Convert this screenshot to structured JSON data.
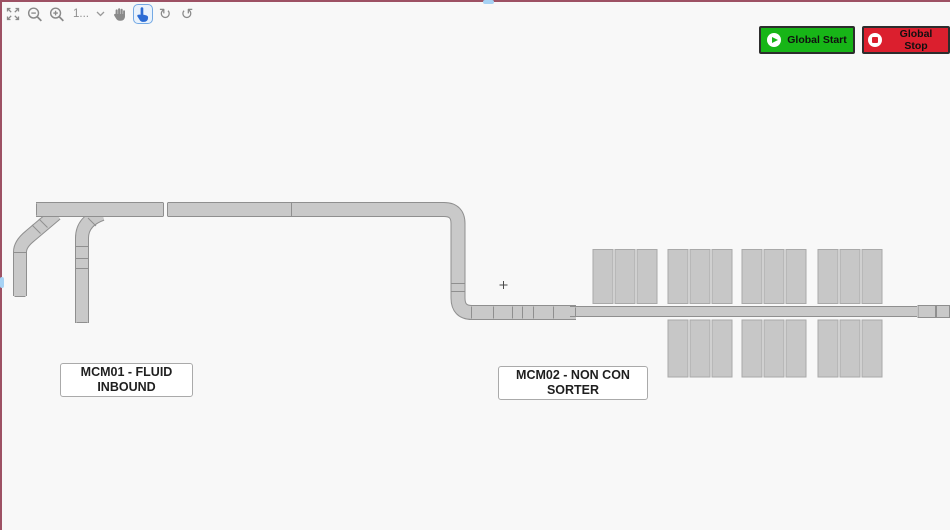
{
  "colors": {
    "window_border": "#9d5164",
    "canvas_bg": "#f8f8f8",
    "belt_fill": "#c9c9c9",
    "belt_stroke": "#8f8f8f",
    "chute_fill": "#c7c7c7",
    "chute_stroke": "#a9a9a9",
    "start_green": "#17b517",
    "stop_red": "#db1f2e",
    "button_border": "#2d2d2d",
    "toolbar_icon": "#8a8a8a",
    "active_tool": "#2b6bd4",
    "active_tool_border": "#74a9e4",
    "active_tool_bg": "#e9f2fc",
    "scroll_thumb": "#a6d2f4",
    "label_border": "#aaaaaa"
  },
  "toolbar": {
    "zoom_level_value": "1...",
    "rotate_glyph": "↻",
    "reset_glyph": "↺"
  },
  "actions": {
    "start_label": "Global Start",
    "stop_label": "Global Stop"
  },
  "labels": {
    "mcm01": {
      "line1": "MCM01 - FLUID",
      "line2": "INBOUND"
    },
    "mcm02": {
      "line1": "MCM02 - NON CON",
      "line2": "SORTER"
    }
  },
  "diagram": {
    "belts": [
      {
        "name": "mcm01-branch-left-belt",
        "path": "M 56 214 L 30 236 Q 20 244 20 252 L 20 296",
        "width": 12
      },
      {
        "name": "mcm01-branch-mid-belt",
        "path": "M 102 214 Q 82 221 82 238 L 82 323",
        "width": 12
      },
      {
        "name": "mcm01-main-belt",
        "path": "M 36 209.5 L 444 209.5 Q 458 209.5 458 223.5 L 458 298 Q 458 312.5 472 312.5 L 576 312.5",
        "width": 13
      },
      {
        "name": "mcm02-sorter-belt",
        "path": "M 570 311.5 L 917 311.5",
        "width": 9
      }
    ],
    "belt_gap": {
      "x": 163.5,
      "y": 201.5,
      "w": 4,
      "h": 16
    },
    "separators": [
      [
        36.5,
        203.5,
        36.5,
        215.5
      ],
      [
        163.5,
        203,
        163.5,
        216
      ],
      [
        167.5,
        203,
        167.5,
        216
      ],
      [
        291.5,
        203,
        291.5,
        216
      ],
      [
        451.5,
        283.5,
        464.5,
        283.5
      ],
      [
        451.5,
        291.5,
        464.5,
        291.5
      ],
      [
        471.5,
        306.5,
        471.5,
        318.5
      ],
      [
        493.5,
        306.5,
        493.5,
        318.5
      ],
      [
        512.5,
        306.5,
        512.5,
        318.5
      ],
      [
        522.5,
        306.5,
        522.5,
        318.5
      ],
      [
        533.5,
        306.5,
        533.5,
        318.5
      ],
      [
        553.5,
        306.5,
        553.5,
        318.5
      ],
      [
        575.5,
        307.5,
        575.5,
        316
      ],
      [
        39,
        219,
        47.5,
        227.5
      ],
      [
        32,
        225,
        40.5,
        233.5
      ],
      [
        88,
        218,
        96,
        226
      ],
      [
        76,
        246.5,
        88,
        246.5
      ],
      [
        76,
        258.5,
        88,
        258.5
      ],
      [
        76,
        268.5,
        88,
        268.5
      ],
      [
        14,
        252.5,
        26,
        252.5
      ],
      [
        14.5,
        296.5,
        25.5,
        296.5
      ],
      [
        76.5,
        322.5,
        87.5,
        322.5
      ]
    ],
    "end_segments": [
      [
        918,
        305.5,
        17.5,
        12
      ],
      [
        936.5,
        305.5,
        13,
        12
      ]
    ],
    "chutes": {
      "w": 20,
      "gap": 2,
      "per_group": 3,
      "top": {
        "y": 249.5,
        "h": 54,
        "group_x": [
          593,
          668,
          742,
          818
        ]
      },
      "bottom": {
        "y": 320,
        "h": 57,
        "group_x": [
          668,
          742,
          818
        ]
      }
    },
    "cross": {
      "x": 503.5,
      "y": 285
    }
  }
}
